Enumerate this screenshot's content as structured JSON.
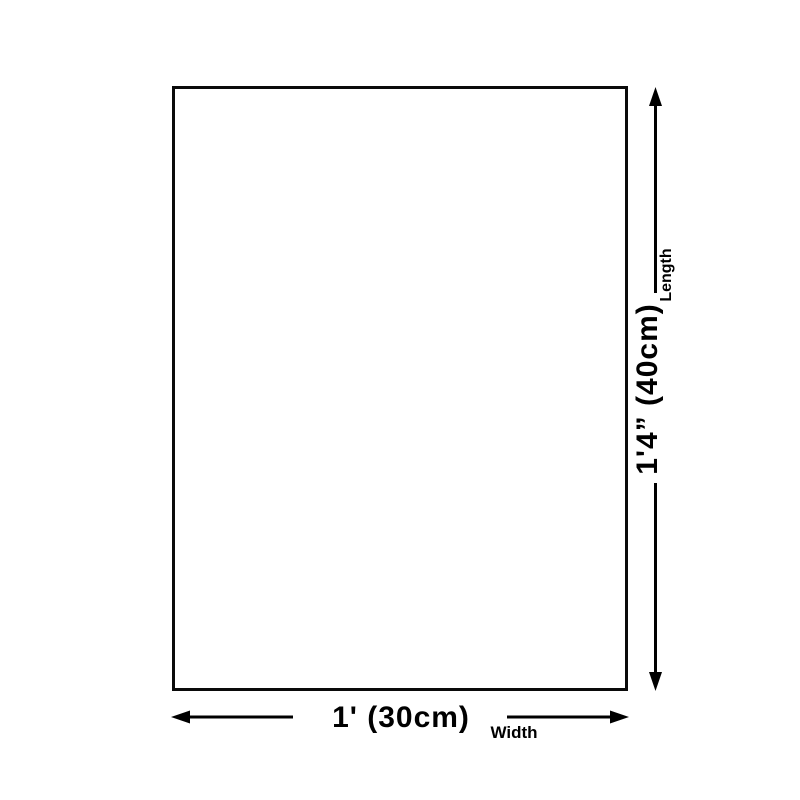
{
  "diagram": {
    "background_color": "#ffffff",
    "line_color": "#000000",
    "length_dimension": {
      "value": "1'4” (40cm)",
      "label": "Length"
    },
    "width_dimension": {
      "value": "1' (30cm)",
      "label": "Width"
    }
  }
}
